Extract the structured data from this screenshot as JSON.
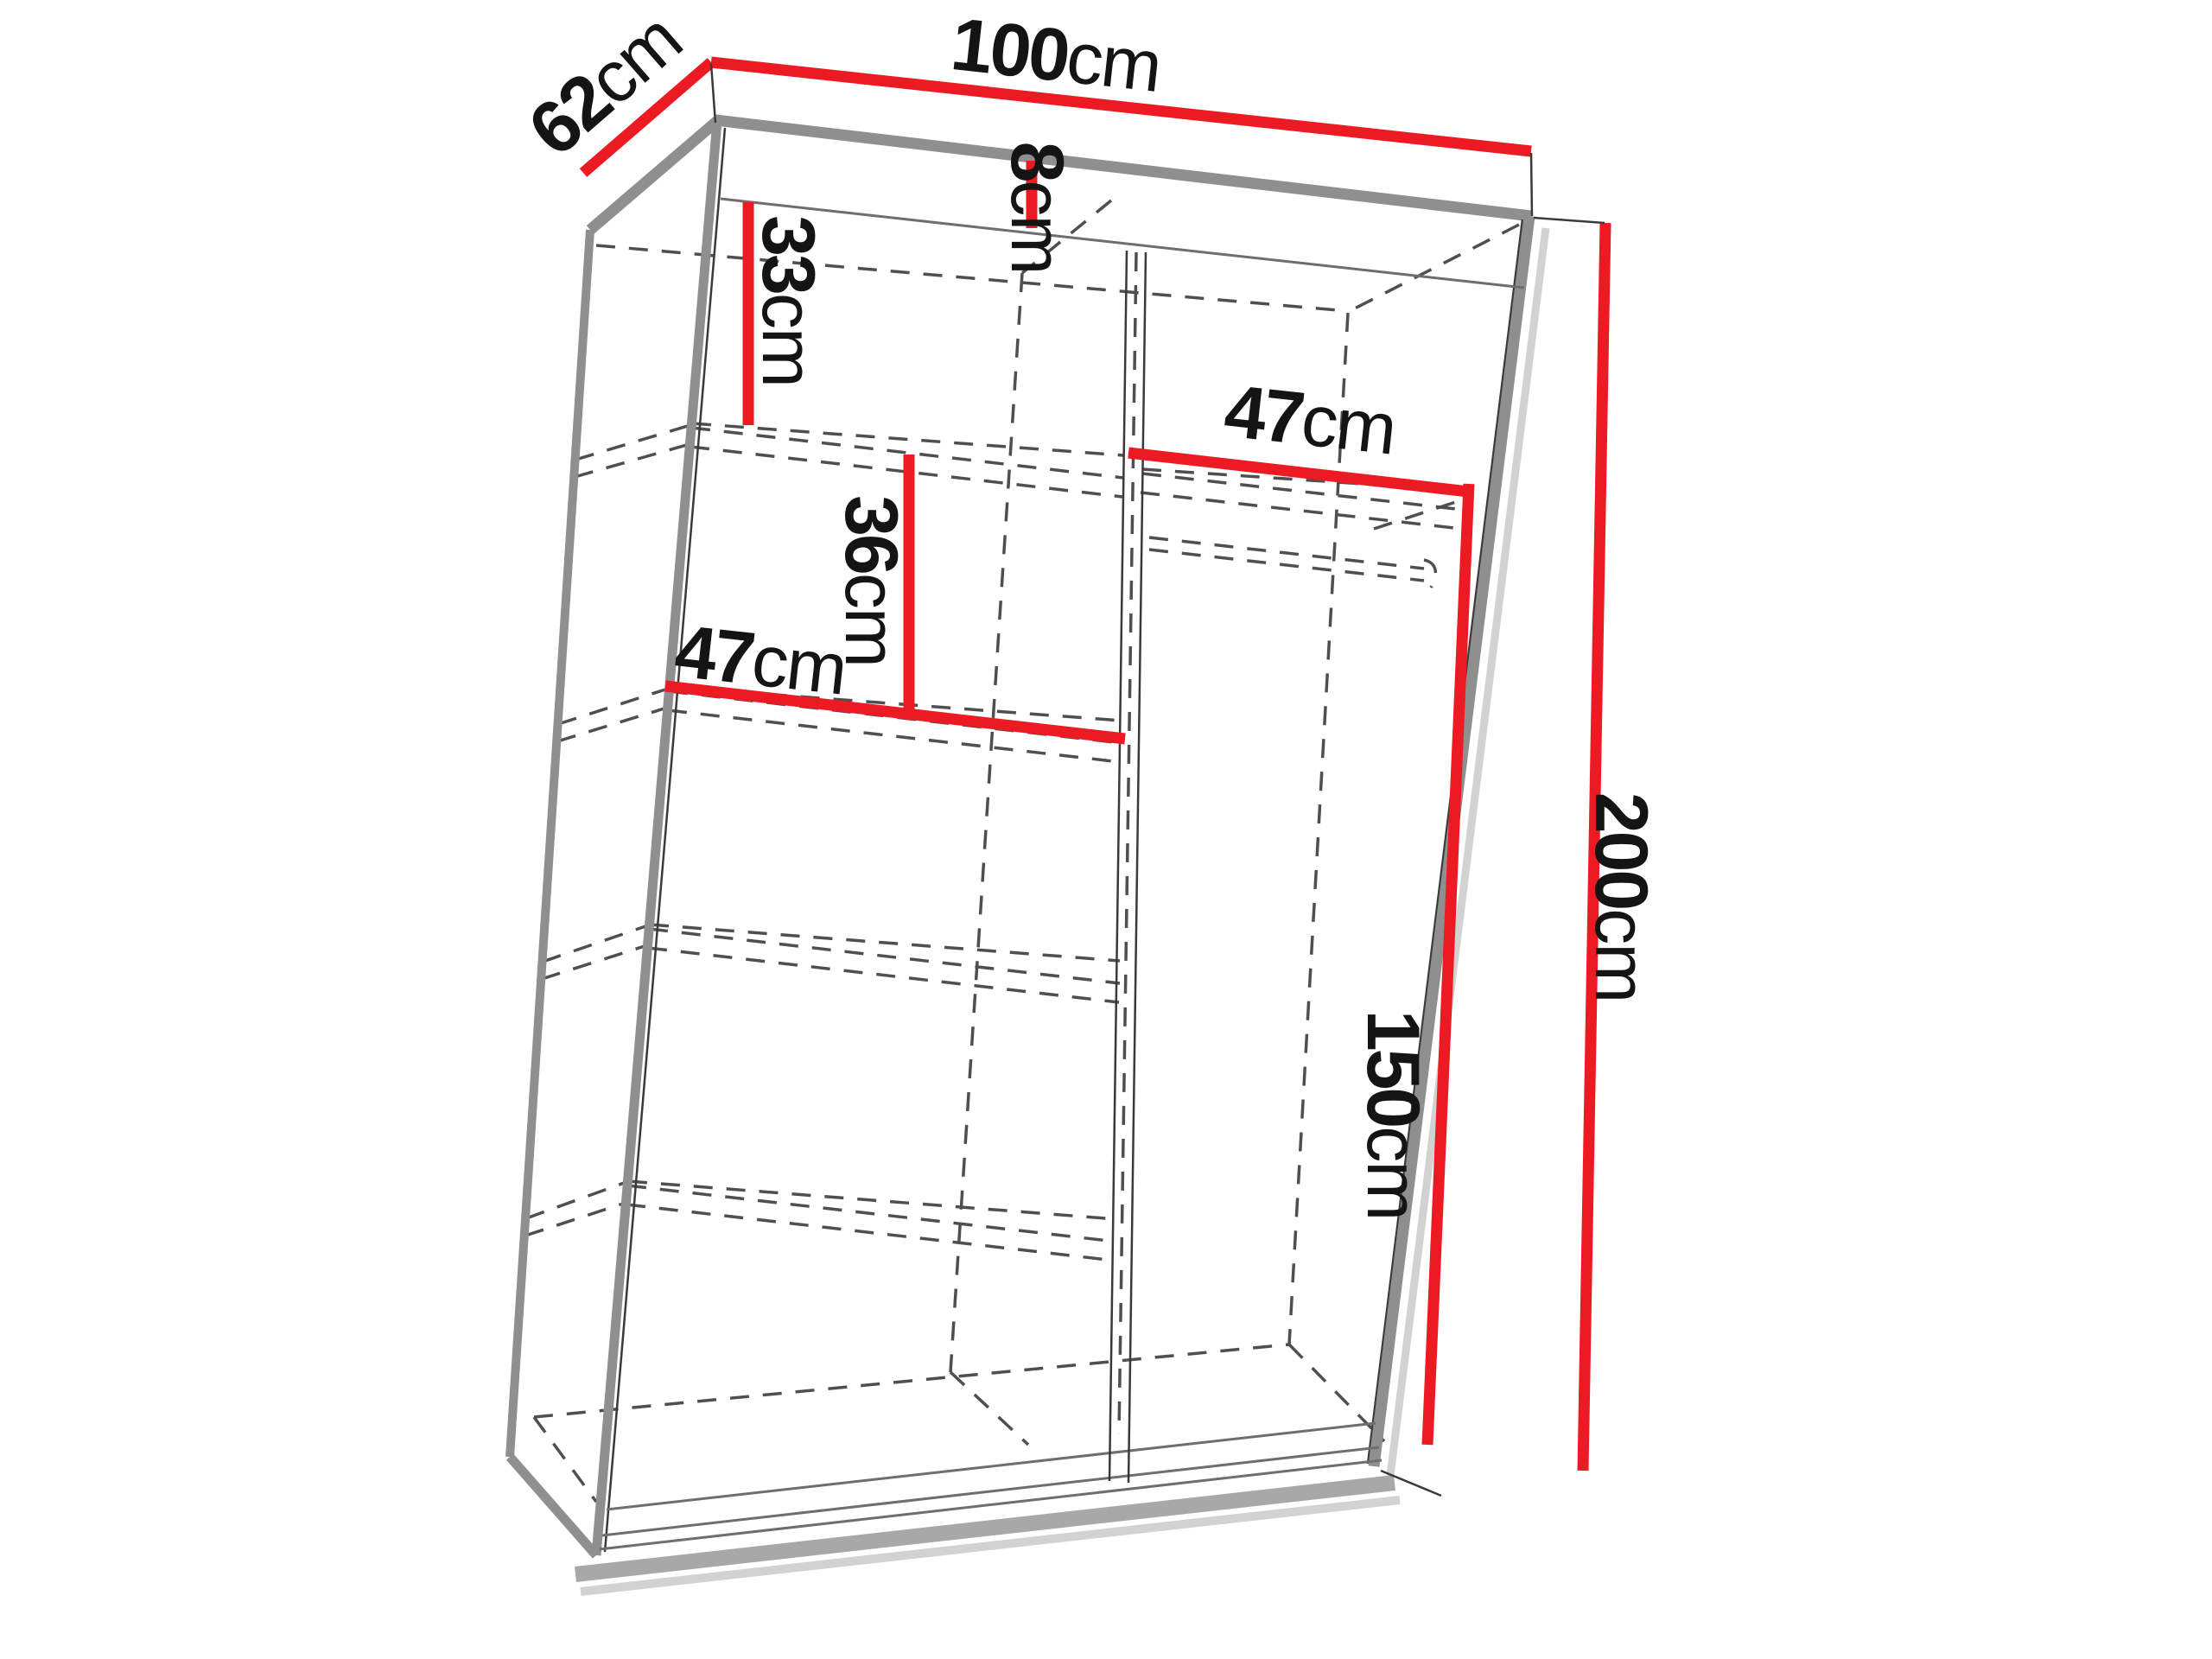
{
  "diagram": {
    "name": "sliding-door wardrobe dimension drawing",
    "unit": "cm",
    "colors": {
      "dimension_line": "#ec1b23",
      "outline": "#8f8f8f",
      "hidden_line": "#4f4f4f",
      "text": "#141414",
      "background": "#ffffff"
    },
    "dims": {
      "depth": {
        "value": "62",
        "unit": "cm"
      },
      "width": {
        "value": "100",
        "unit": "cm"
      },
      "top_panel": {
        "value": "8",
        "unit": "cm"
      },
      "upper_gap": {
        "value": "33",
        "unit": "cm"
      },
      "right_shelf": {
        "value": "47",
        "unit": "cm"
      },
      "shelf_gap": {
        "value": "36",
        "unit": "cm"
      },
      "left_shelf": {
        "value": "47",
        "unit": "cm"
      },
      "hanging": {
        "value": "150",
        "unit": "cm"
      },
      "height": {
        "value": "200",
        "unit": "cm"
      }
    }
  }
}
